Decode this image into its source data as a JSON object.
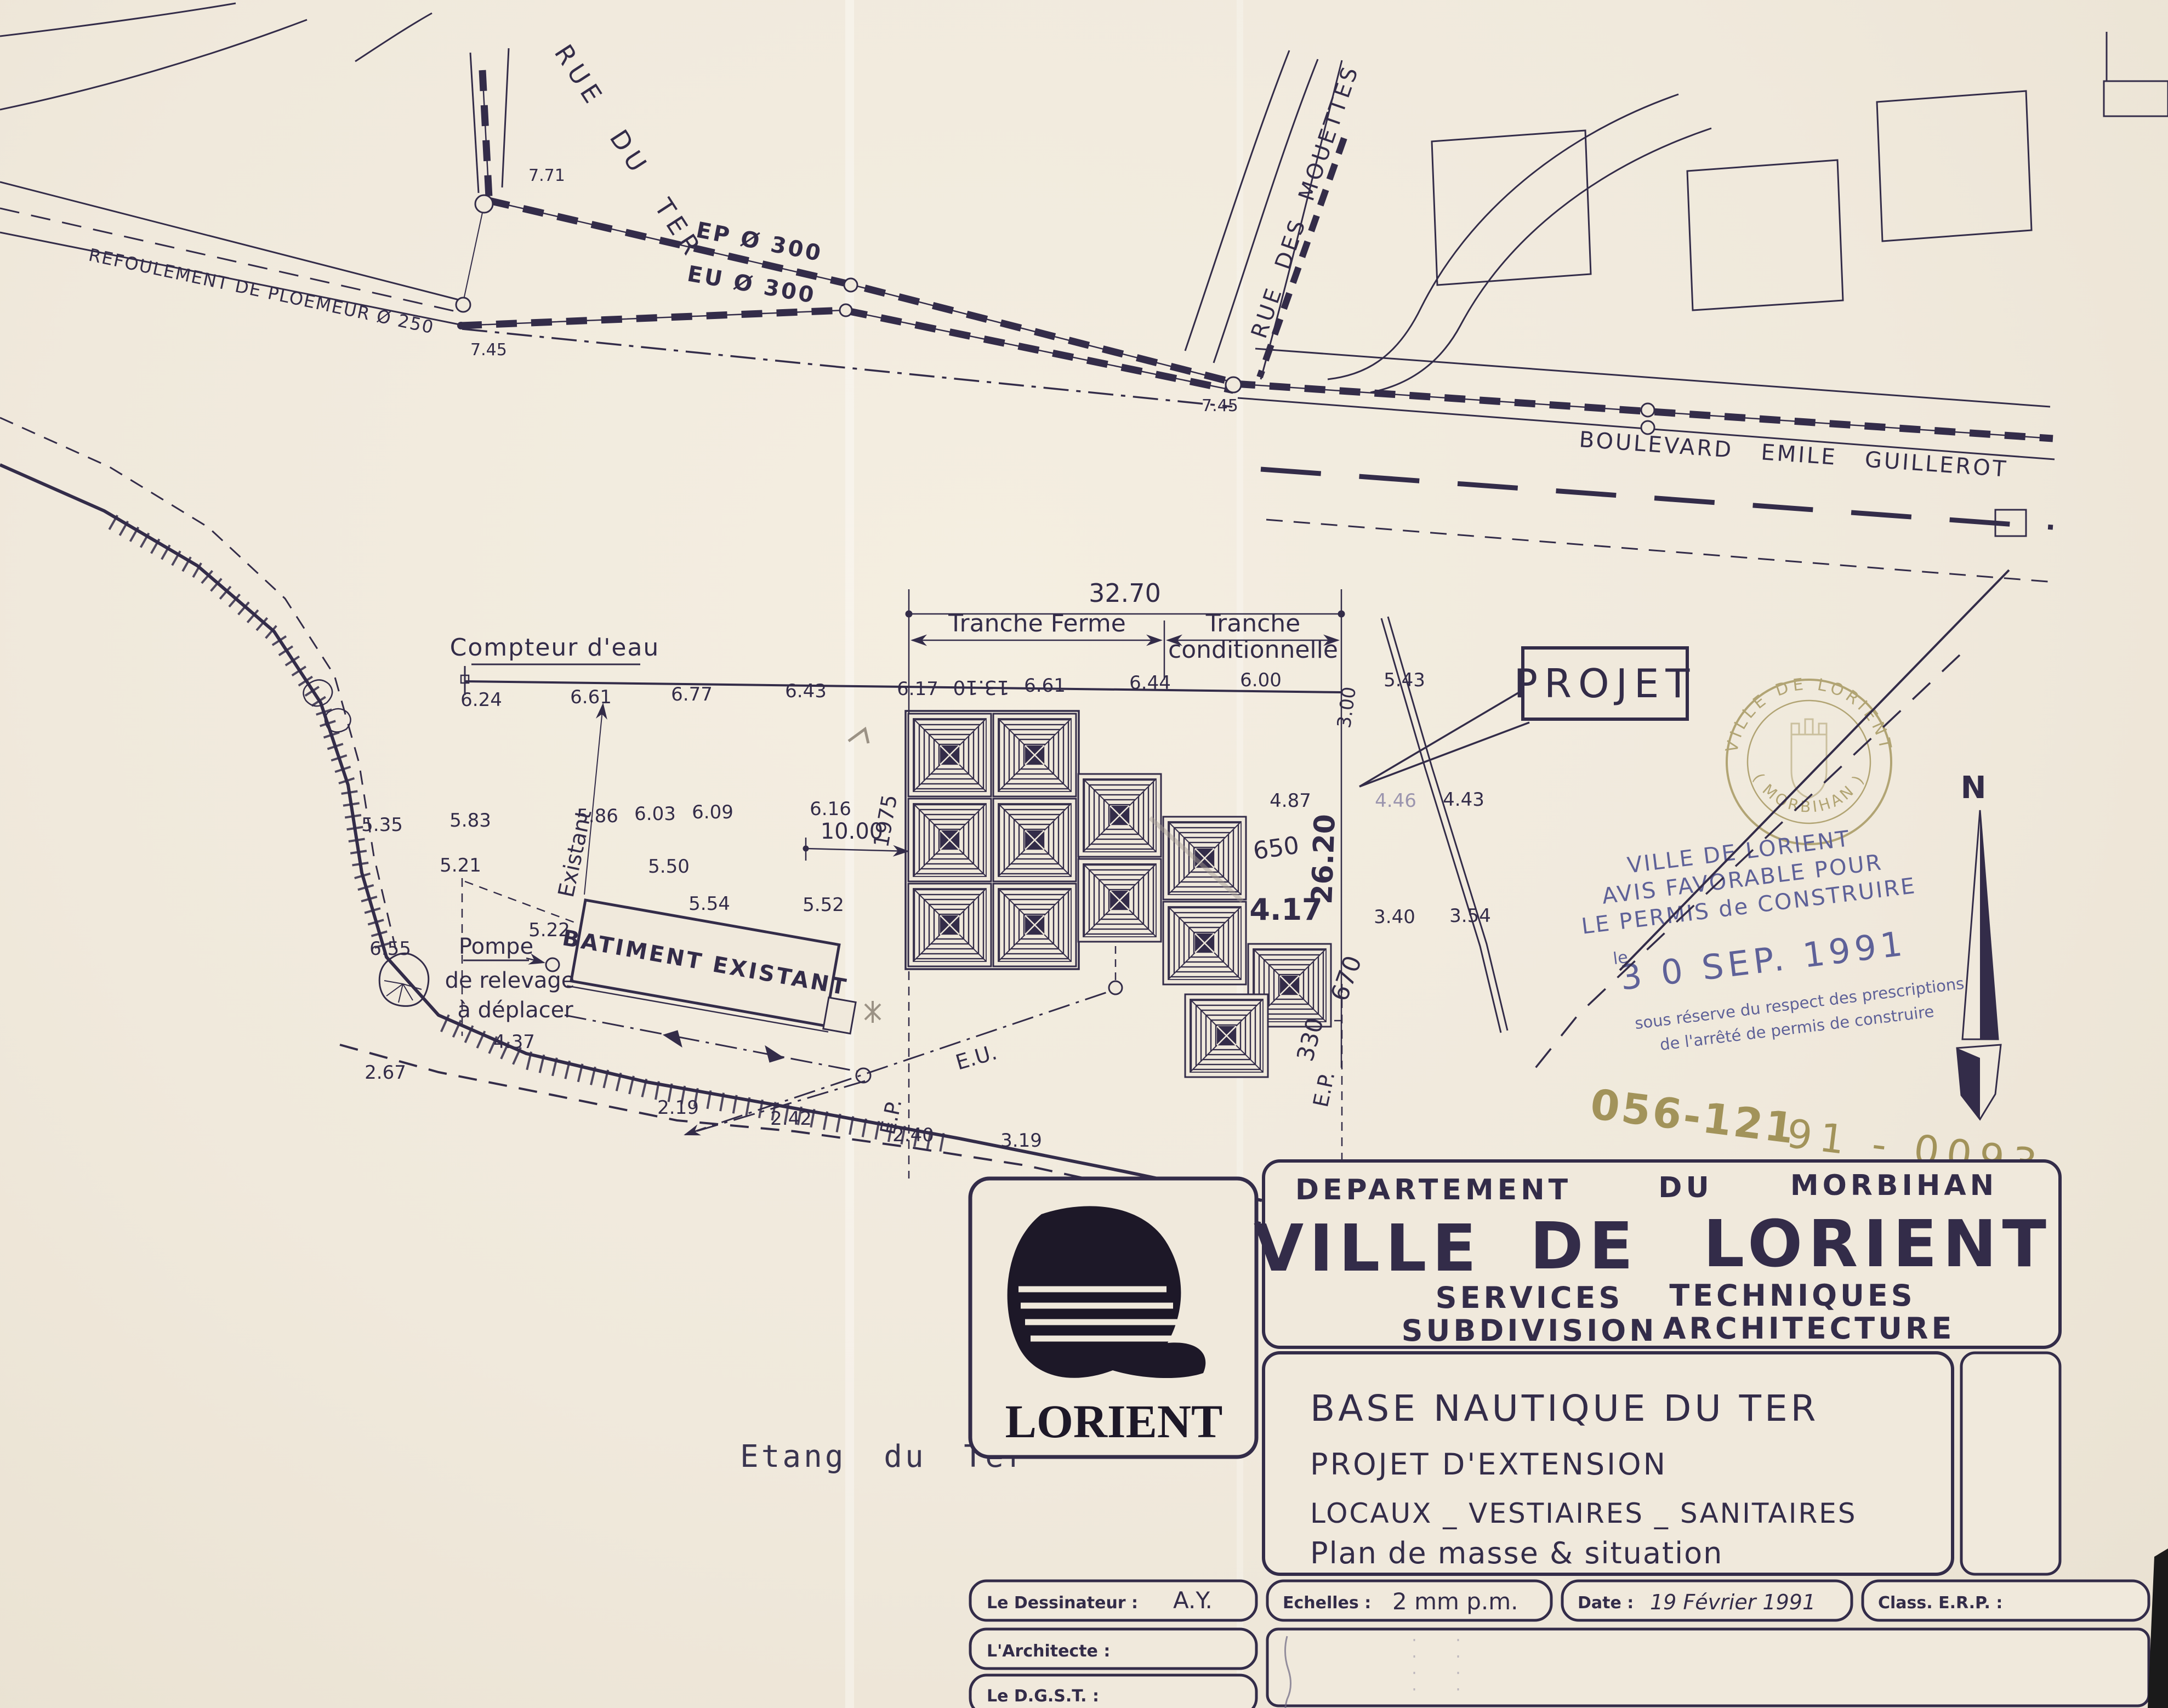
{
  "colors": {
    "paper": "#f0e9dc",
    "ink": "#332c49",
    "pencil": "#9b9285",
    "stamp_blue": "#5e6198",
    "stamp_gold": "#a2935a"
  },
  "streets": {
    "rue_du_ter": "RUE DU TER",
    "rue_des_mouettes": "RUE DES MOUETTES",
    "boulevard": "BOULEVARD  EMILE  GUILLEROT"
  },
  "utilities": {
    "refoulement": "REFOULEMENT DE PLOEMEUR  Ø 250",
    "ep300": "EP Ø 300",
    "eu300": "EU Ø 300",
    "eu": "E.U.",
    "ep_left": "E.P.",
    "ep_right": "E.P."
  },
  "site": {
    "compteur_deau": "Compteur d'eau",
    "projet": "PROJET",
    "batiment_existant": "BATIMENT EXISTANT",
    "existant": "Existant",
    "pompe": {
      "l1": "Pompe",
      "l2": "de relevage",
      "l3": "à déplacer"
    },
    "etang": "Etang  du  Ter",
    "north": "N"
  },
  "dimensions": {
    "total": "32.70",
    "tranche_ferme": "Tranche Ferme",
    "tranche_cond_1": "Tranche",
    "tranche_cond_2": "conditionnelle",
    "d10": "10.00",
    "d26": "26.20",
    "d3": "3.00"
  },
  "spot_elevations": [
    "6.24",
    "6.61",
    "6.77",
    "6.43",
    "6.17",
    "6.61",
    "6.44",
    "6.00",
    "5.43",
    "5.35",
    "5.83",
    "5.86",
    "6.03",
    "6.09",
    "6.16",
    "5.21",
    "5.50",
    "5.54",
    "5.52",
    "6.55",
    "5.22",
    "4.37",
    "2.67",
    "2.19",
    "2.42",
    "2.40",
    "3.19",
    "4.87",
    "4.46",
    "4.43",
    "3.40",
    "3.54",
    "4.17",
    "7.71",
    "7.45",
    "7.45"
  ],
  "pencil_notes": [
    "13.10",
    "1975",
    "650",
    "670",
    "330"
  ],
  "stamp": {
    "ring_top": "VILLE DE LORIENT",
    "ring_bottom": "( MORBIHAN )",
    "l1": "VILLE DE LORIENT",
    "l2": "AVIS FAVORABLE POUR",
    "l3": "LE PERMIS de CONSTRUIRE",
    "le": "le",
    "date": "3 0 SEP. 1991",
    "s1": "sous réserve du respect des prescriptions",
    "s2": "de l'arrêté de permis de construire",
    "permit1": "056-121",
    "permit2": "91 - 0093"
  },
  "title_block": {
    "dept1": "DEPARTEMENT",
    "dept2": "DU",
    "dept3": "MORBIHAN",
    "ville1": "VILLE",
    "ville2": "DE",
    "ville3": "LORIENT",
    "serv1": "SERVICES",
    "serv2": "TECHNIQUES",
    "sub1": "SUBDIVISION",
    "sub2": "ARCHITECTURE",
    "logo": "LORIENT",
    "project1": "BASE NAUTIQUE DU TER",
    "project2": "PROJET D'EXTENSION",
    "project3": "LOCAUX _ VESTIAIRES _ SANITAIRES",
    "project4": "Plan de masse & situation",
    "dessinateur_label": "Le Dessinateur :",
    "dessinateur_value": "A.Y.",
    "echelles_label": "Echelles :",
    "echelles_value": "2 mm  p.m.",
    "date_label": "Date :",
    "date_value": "19 Février 1991",
    "classe_label": "Class. E.R.P. :",
    "architecte_label": "L'Architecte :",
    "dgst_label": "Le D.G.S.T. :"
  }
}
